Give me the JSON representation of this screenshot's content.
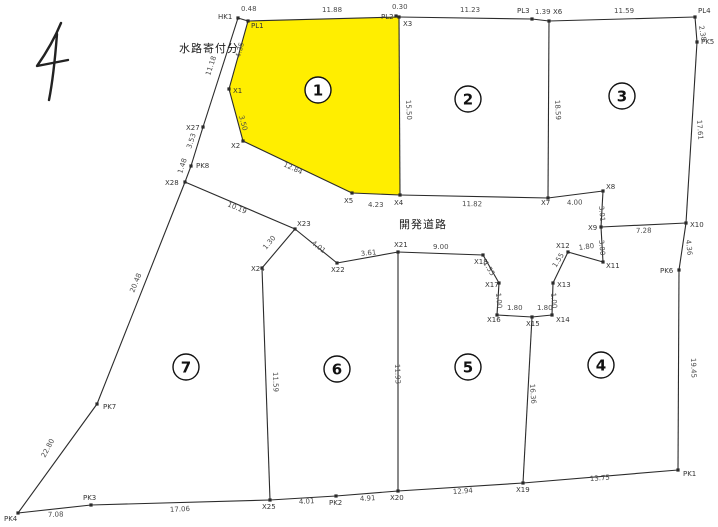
{
  "colors": {
    "background": "#ffffff",
    "line": "#2b2b2b",
    "highlight_fill": "#ffee00",
    "dim_text": "#4a4a4a",
    "point_text": "#333333",
    "circle_fill": "#ffffff"
  },
  "annotations": {
    "waterway_label": "水路寄付分",
    "road_label": "開発道路"
  },
  "parcel_numbers": [
    {
      "label": "1",
      "x": 318,
      "y": 90
    },
    {
      "label": "2",
      "x": 468,
      "y": 99
    },
    {
      "label": "3",
      "x": 622,
      "y": 96
    },
    {
      "label": "4",
      "x": 601,
      "y": 365
    },
    {
      "label": "5",
      "x": 468,
      "y": 367
    },
    {
      "label": "6",
      "x": 337,
      "y": 369
    },
    {
      "label": "7",
      "x": 186,
      "y": 367
    }
  ],
  "geometry": {
    "points": [
      {
        "id": "HK1",
        "x": 238,
        "y": 18,
        "lx": 218,
        "ly": 19
      },
      {
        "id": "PL1",
        "x": 248,
        "y": 21,
        "lx": 251,
        "ly": 28
      },
      {
        "id": "PL2",
        "x": 396,
        "y": 16,
        "lx": 381,
        "ly": 19
      },
      {
        "id": "X3",
        "x": 399,
        "y": 17,
        "lx": 403,
        "ly": 26
      },
      {
        "id": "PL3",
        "x": 532,
        "y": 19,
        "lx": 517,
        "ly": 13
      },
      {
        "id": "X6",
        "x": 549,
        "y": 21,
        "lx": 553,
        "ly": 14
      },
      {
        "id": "PL4",
        "x": 695,
        "y": 17,
        "lx": 698,
        "ly": 13
      },
      {
        "id": "PK5",
        "x": 697,
        "y": 42,
        "lx": 701,
        "ly": 44
      },
      {
        "id": "X10",
        "x": 686,
        "y": 223,
        "lx": 690,
        "ly": 227
      },
      {
        "id": "PK6",
        "x": 679,
        "y": 270,
        "lx": 660,
        "ly": 273
      },
      {
        "id": "PK1",
        "x": 678,
        "y": 470,
        "lx": 683,
        "ly": 476
      },
      {
        "id": "X19",
        "x": 523,
        "y": 483,
        "lx": 516,
        "ly": 492
      },
      {
        "id": "X20",
        "x": 398,
        "y": 491,
        "lx": 390,
        "ly": 500
      },
      {
        "id": "PK2",
        "x": 336,
        "y": 496,
        "lx": 329,
        "ly": 505
      },
      {
        "id": "X25",
        "x": 270,
        "y": 500,
        "lx": 262,
        "ly": 509
      },
      {
        "id": "PK3",
        "x": 91,
        "y": 505,
        "lx": 83,
        "ly": 500
      },
      {
        "id": "PK4",
        "x": 18,
        "y": 513,
        "lx": 4,
        "ly": 521
      },
      {
        "id": "PK7",
        "x": 97,
        "y": 404,
        "lx": 103,
        "ly": 409
      },
      {
        "id": "X28",
        "x": 185,
        "y": 182,
        "lx": 165,
        "ly": 185
      },
      {
        "id": "PK8",
        "x": 191,
        "y": 166,
        "lx": 196,
        "ly": 168
      },
      {
        "id": "X27",
        "x": 203,
        "y": 127,
        "lx": 186,
        "ly": 130
      },
      {
        "id": "X1",
        "x": 229,
        "y": 89,
        "lx": 233,
        "ly": 93
      },
      {
        "id": "X2",
        "x": 243,
        "y": 141,
        "lx": 231,
        "ly": 148
      },
      {
        "id": "X5",
        "x": 352,
        "y": 193,
        "lx": 344,
        "ly": 203
      },
      {
        "id": "X4",
        "x": 400,
        "y": 195,
        "lx": 394,
        "ly": 205
      },
      {
        "id": "X7",
        "x": 548,
        "y": 198,
        "lx": 541,
        "ly": 205
      },
      {
        "id": "X8",
        "x": 603,
        "y": 191,
        "lx": 606,
        "ly": 189
      },
      {
        "id": "X9",
        "x": 601,
        "y": 227,
        "lx": 588,
        "ly": 230
      },
      {
        "id": "X11",
        "x": 603,
        "y": 262,
        "lx": 606,
        "ly": 268
      },
      {
        "id": "X12",
        "x": 568,
        "y": 252,
        "lx": 556,
        "ly": 248
      },
      {
        "id": "X13",
        "x": 553,
        "y": 283,
        "lx": 557,
        "ly": 287
      },
      {
        "id": "X14",
        "x": 552,
        "y": 315,
        "lx": 556,
        "ly": 322
      },
      {
        "id": "X15",
        "x": 532,
        "y": 317,
        "lx": 526,
        "ly": 326
      },
      {
        "id": "X16",
        "x": 497,
        "y": 315,
        "lx": 487,
        "ly": 322
      },
      {
        "id": "X17",
        "x": 499,
        "y": 283,
        "lx": 485,
        "ly": 287
      },
      {
        "id": "X18",
        "x": 483,
        "y": 255,
        "lx": 474,
        "ly": 264
      },
      {
        "id": "X23",
        "x": 295,
        "y": 229,
        "lx": 297,
        "ly": 226
      },
      {
        "id": "X22",
        "x": 337,
        "y": 263,
        "lx": 331,
        "ly": 272
      },
      {
        "id": "X21",
        "x": 398,
        "y": 252,
        "lx": 394,
        "ly": 247
      },
      {
        "id": "X24",
        "x": 262,
        "y": 268,
        "lx": 251,
        "ly": 271
      }
    ],
    "edges": [
      [
        "HK1",
        "PL1"
      ],
      [
        "PL1",
        "X3"
      ],
      [
        "X3",
        "PL3"
      ],
      [
        "PL3",
        "X6"
      ],
      [
        "X6",
        "PL4"
      ],
      [
        "PL4",
        "PK5"
      ],
      [
        "PK5",
        "X10"
      ],
      [
        "X10",
        "PK6"
      ],
      [
        "PK6",
        "PK1"
      ],
      [
        "PK1",
        "X19"
      ],
      [
        "X19",
        "X20"
      ],
      [
        "X20",
        "PK2"
      ],
      [
        "PK2",
        "X25"
      ],
      [
        "X25",
        "PK3"
      ],
      [
        "PK3",
        "PK4"
      ],
      [
        "PK4",
        "PK7"
      ],
      [
        "PK7",
        "X28"
      ],
      [
        "X28",
        "PK8"
      ],
      [
        "PK8",
        "X27"
      ],
      [
        "X27",
        "HK1"
      ],
      [
        "PL1",
        "X1"
      ],
      [
        "X1",
        "X2"
      ],
      [
        "X2",
        "X5"
      ],
      [
        "X5",
        "X4"
      ],
      [
        "X4",
        "X3"
      ],
      [
        "X4",
        "X7"
      ],
      [
        "X7",
        "X8"
      ],
      [
        "X8",
        "X9"
      ],
      [
        "X9",
        "X10"
      ],
      [
        "X9",
        "X11"
      ],
      [
        "X11",
        "X12"
      ],
      [
        "X12",
        "X13"
      ],
      [
        "X13",
        "X14"
      ],
      [
        "X14",
        "X15"
      ],
      [
        "X15",
        "X16"
      ],
      [
        "X16",
        "X17"
      ],
      [
        "X17",
        "X18"
      ],
      [
        "X18",
        "X21"
      ],
      [
        "X21",
        "X22"
      ],
      [
        "X22",
        "X23"
      ],
      [
        "X23",
        "X24"
      ],
      [
        "X23",
        "X28"
      ],
      [
        "X24",
        "X25"
      ],
      [
        "X21",
        "X20"
      ],
      [
        "X15",
        "X19"
      ],
      [
        "X6",
        "X7"
      ]
    ],
    "highlight_polygon": [
      "PL1",
      "X3",
      "X4",
      "X5",
      "X2",
      "X1"
    ],
    "dim_labels": [
      {
        "t": "0.48",
        "x": 241,
        "y": 11,
        "r": 0
      },
      {
        "t": "11.88",
        "x": 322,
        "y": 12,
        "r": 0
      },
      {
        "t": "0.30",
        "x": 392,
        "y": 9,
        "r": 0
      },
      {
        "t": "11.23",
        "x": 460,
        "y": 12,
        "r": 0
      },
      {
        "t": "1.39",
        "x": 535,
        "y": 14,
        "r": 0
      },
      {
        "t": "11.59",
        "x": 614,
        "y": 13,
        "r": 0
      },
      {
        "t": "2.38",
        "x": 699,
        "y": 26,
        "r": 80
      },
      {
        "t": "17.61",
        "x": 697,
        "y": 120,
        "r": 86
      },
      {
        "t": "7.28",
        "x": 636,
        "y": 233,
        "r": -1
      },
      {
        "t": "4.36",
        "x": 686,
        "y": 240,
        "r": 84
      },
      {
        "t": "19.45",
        "x": 691,
        "y": 358,
        "r": 88
      },
      {
        "t": "13.75",
        "x": 590,
        "y": 481,
        "r": -4
      },
      {
        "t": "12.94",
        "x": 453,
        "y": 494,
        "r": -4
      },
      {
        "t": "4.91",
        "x": 360,
        "y": 501,
        "r": -3
      },
      {
        "t": "4.01",
        "x": 299,
        "y": 504,
        "r": -3
      },
      {
        "t": "17.06",
        "x": 170,
        "y": 512,
        "r": -3
      },
      {
        "t": "7.08",
        "x": 48,
        "y": 517,
        "r": -2
      },
      {
        "t": "22.80",
        "x": 45,
        "y": 458,
        "r": -62
      },
      {
        "t": "20.48",
        "x": 134,
        "y": 293,
        "r": -68
      },
      {
        "t": "1.48",
        "x": 182,
        "y": 174,
        "r": -72
      },
      {
        "t": "3.53",
        "x": 191,
        "y": 149,
        "r": -72
      },
      {
        "t": "11.18",
        "x": 210,
        "y": 76,
        "r": -72
      },
      {
        "t": "4.35",
        "x": 240,
        "y": 58,
        "r": -75
      },
      {
        "t": "3.50",
        "x": 239,
        "y": 116,
        "r": 75
      },
      {
        "t": "12.84",
        "x": 283,
        "y": 166,
        "r": 25
      },
      {
        "t": "4.23",
        "x": 368,
        "y": 207,
        "r": 0
      },
      {
        "t": "11.82",
        "x": 462,
        "y": 206,
        "r": 1
      },
      {
        "t": "4.00",
        "x": 567,
        "y": 205,
        "r": -2
      },
      {
        "t": "3.01",
        "x": 599,
        "y": 206,
        "r": 85
      },
      {
        "t": "3.00",
        "x": 599,
        "y": 240,
        "r": 85
      },
      {
        "t": "1.80",
        "x": 579,
        "y": 250,
        "r": -8
      },
      {
        "t": "1.55",
        "x": 556,
        "y": 268,
        "r": -58
      },
      {
        "t": "1.00",
        "x": 551,
        "y": 293,
        "r": 85
      },
      {
        "t": "1.80",
        "x": 537,
        "y": 310,
        "r": 0
      },
      {
        "t": "1.80",
        "x": 507,
        "y": 310,
        "r": 0
      },
      {
        "t": "1.00",
        "x": 496,
        "y": 293,
        "r": 85
      },
      {
        "t": "1.55",
        "x": 483,
        "y": 263,
        "r": 58
      },
      {
        "t": "9.00",
        "x": 433,
        "y": 249,
        "r": 0
      },
      {
        "t": "3.61",
        "x": 361,
        "y": 256,
        "r": -6
      },
      {
        "t": "4.01",
        "x": 311,
        "y": 244,
        "r": 37
      },
      {
        "t": "1.30",
        "x": 266,
        "y": 250,
        "r": -50
      },
      {
        "t": "10.19",
        "x": 227,
        "y": 206,
        "r": 23
      },
      {
        "t": "15.50",
        "x": 406,
        "y": 100,
        "r": 87
      },
      {
        "t": "18.59",
        "x": 555,
        "y": 100,
        "r": 87
      },
      {
        "t": "11.59",
        "x": 273,
        "y": 372,
        "r": 88
      },
      {
        "t": "11.93",
        "x": 395,
        "y": 364,
        "r": 88
      },
      {
        "t": "16.36",
        "x": 530,
        "y": 384,
        "r": 86
      }
    ]
  }
}
